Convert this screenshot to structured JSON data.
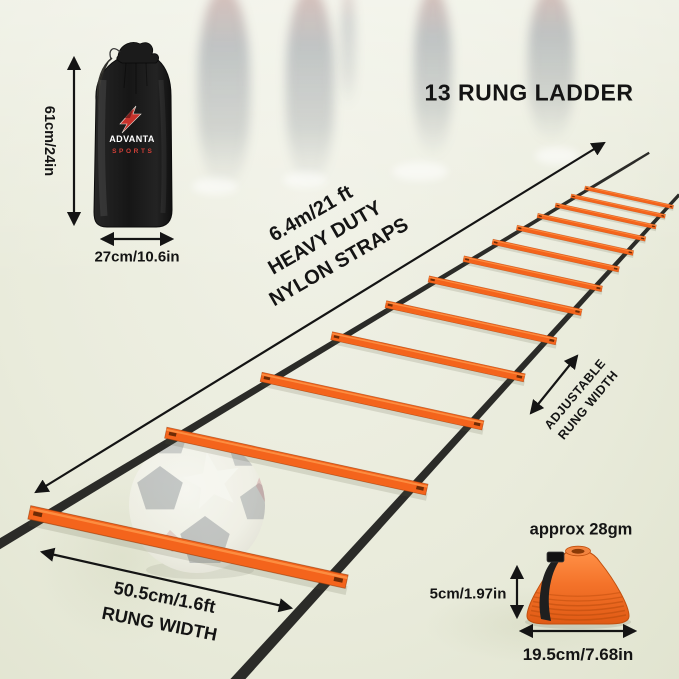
{
  "title": "13 RUNG LADDER",
  "bag": {
    "brand": "ADVANTA",
    "brand_sub": "SPORTS",
    "height_label": "61cm/24in",
    "width_label": "27cm/10.6in"
  },
  "ladder": {
    "rung_count": 13,
    "length_label_line1": "6.4m/21 ft",
    "length_label_line2": "HEAVY DUTY",
    "length_label_line3": "NYLON STRAPS",
    "adjustable_label_line1": "ADJUSTABLE",
    "adjustable_label_line2": "RUNG WIDTH",
    "rung_width_label_line1": "50.5cm/1.6ft",
    "rung_width_label_line2": "RUNG WIDTH"
  },
  "cones": {
    "weight_label": "approx 28gm",
    "height_label": "5cm/1.97in",
    "diameter_label": "19.5cm/7.68in"
  },
  "colors": {
    "background": "#eaecdc",
    "rung_orange": "#f4641c",
    "strap_black": "#2b2b28",
    "cone_orange": "#ee6e28",
    "text": "#141414",
    "brand_red": "#c8322c",
    "bag_black": "#1c1c1c"
  }
}
